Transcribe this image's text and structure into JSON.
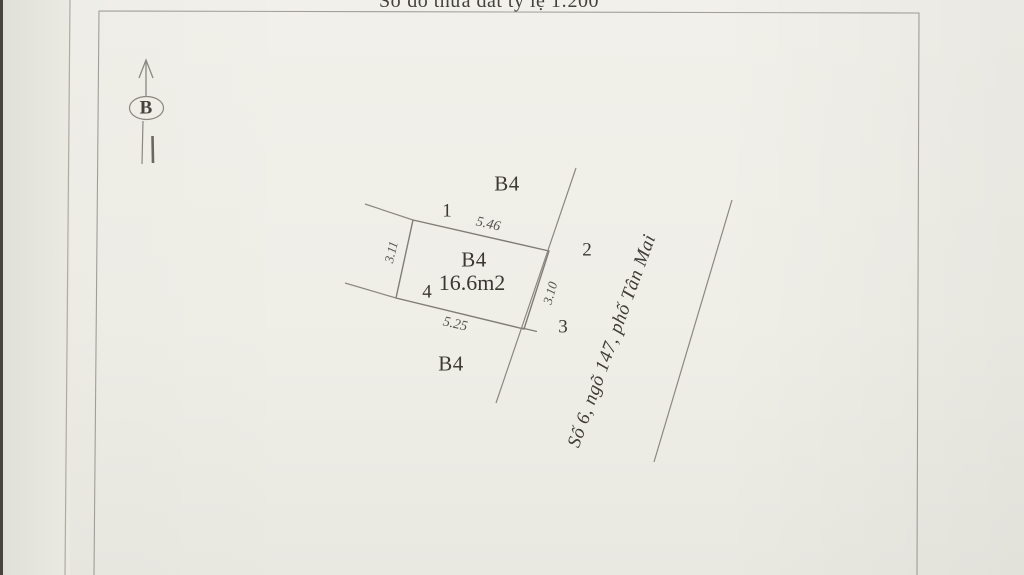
{
  "page": {
    "title": "Sơ đồ thửa đất tỷ lệ 1:200"
  },
  "north_indicator": {
    "label": "B"
  },
  "parcel": {
    "name": "B4",
    "area": "16.6m2",
    "corner_labels": [
      "1",
      "2",
      "3",
      "4"
    ],
    "dimensions": {
      "top": "5.46",
      "left": "3.11",
      "bottom": "5.25",
      "right": "3.10"
    }
  },
  "adjacent": {
    "north_label": "B4",
    "south_label": "B4"
  },
  "street": {
    "name": "Số 6, ngõ 147, phố Tân Mai"
  },
  "colors": {
    "paper": "#efeee8",
    "pencil_line": "#8b8880",
    "parcel_line": "#807d76",
    "frame_line": "#a29f99",
    "ink": "#3a3734",
    "paper_edge": "#4a443e"
  }
}
